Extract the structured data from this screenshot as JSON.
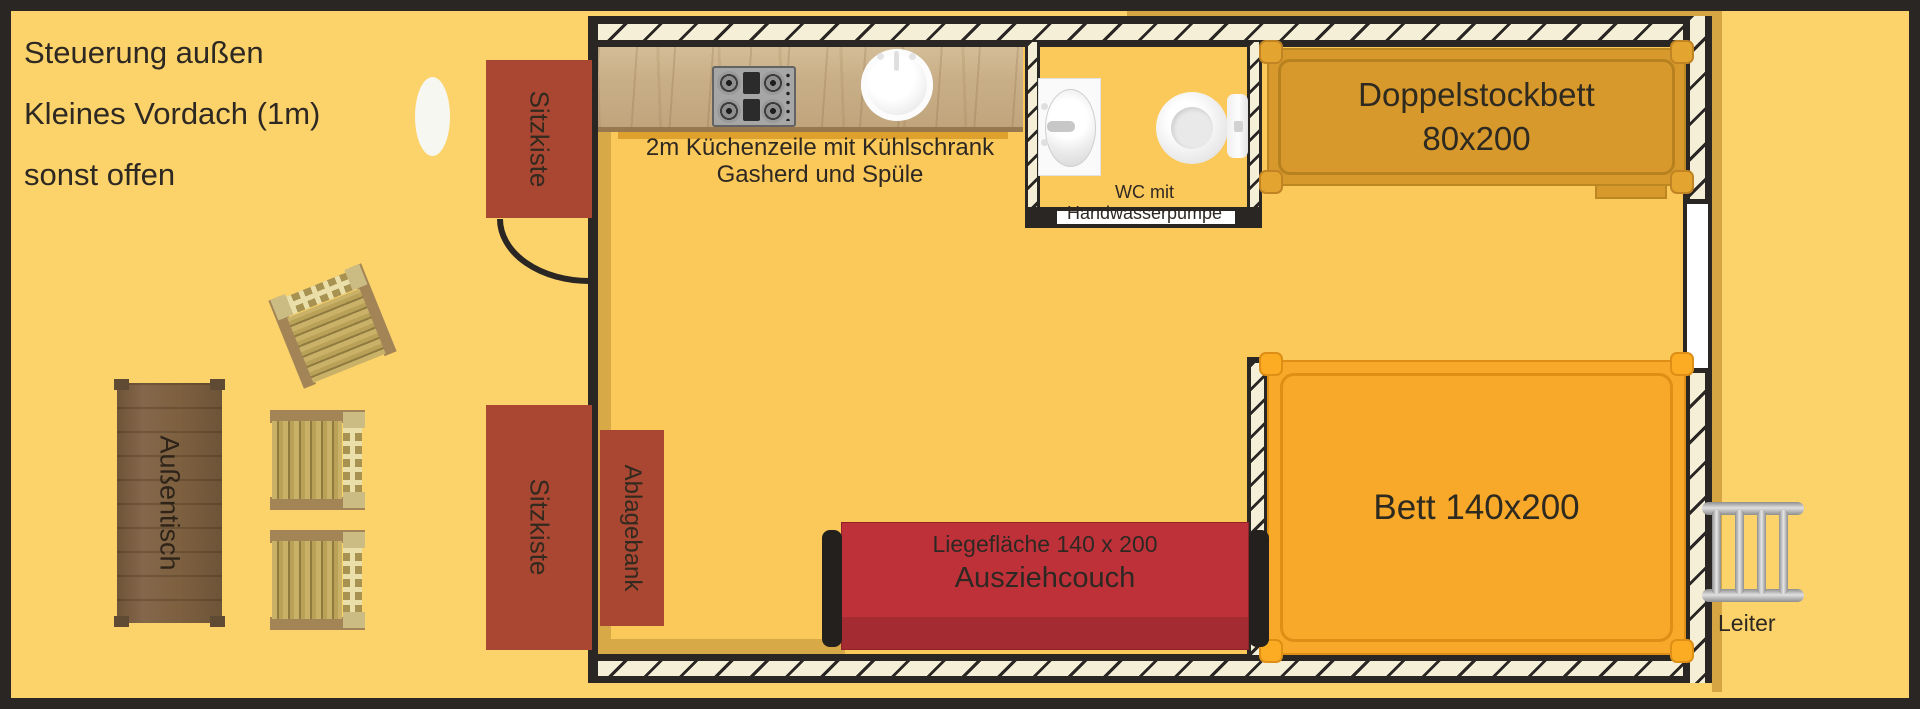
{
  "annotations": {
    "note_line1": "Steuerung außen",
    "note_line2": "Kleines Vordach (1m)",
    "note_line3": "sonst offen"
  },
  "rooms": {
    "kitchen_label_line1": "2m Küchenzeile mit Kühlschrank",
    "kitchen_label_line2": "Gasherd und Spüle",
    "wc_label": "WC mit Handwasserpumpe"
  },
  "furniture": {
    "bunk_bed_line1": "Doppelstockbett",
    "bunk_bed_line2": "80x200",
    "double_bed_label": "Bett 140x200",
    "couch_line1": "Liegefläche 140 x 200",
    "couch_line2": "Ausziehcouch",
    "storage_bench_label": "Ablagebank",
    "seat_chest_top_label": "Sitzkiste",
    "seat_chest_bottom_label": "Sitzkiste",
    "outdoor_table_label": "Außentisch",
    "ladder_label": "Leiter"
  },
  "colors": {
    "outdoor_background": "#FCD36A",
    "floor": "#FBC85A",
    "wall_black": "#2A2623",
    "wall_hatch_cream": "#F6EFD8",
    "shadow_tan": "#D4A542",
    "chest_red": "#A94732",
    "couch_red": "#BE3139",
    "bunk_bed_orange": "#D7992C",
    "bed_orange": "#F9A929",
    "counter_wood": "#C9AF88",
    "table_brown": "#7E6140",
    "chair_slat_gold": "#C9B268",
    "ladder_gray": "#B3B3B3",
    "fixture_white": "#FAFAFA"
  }
}
